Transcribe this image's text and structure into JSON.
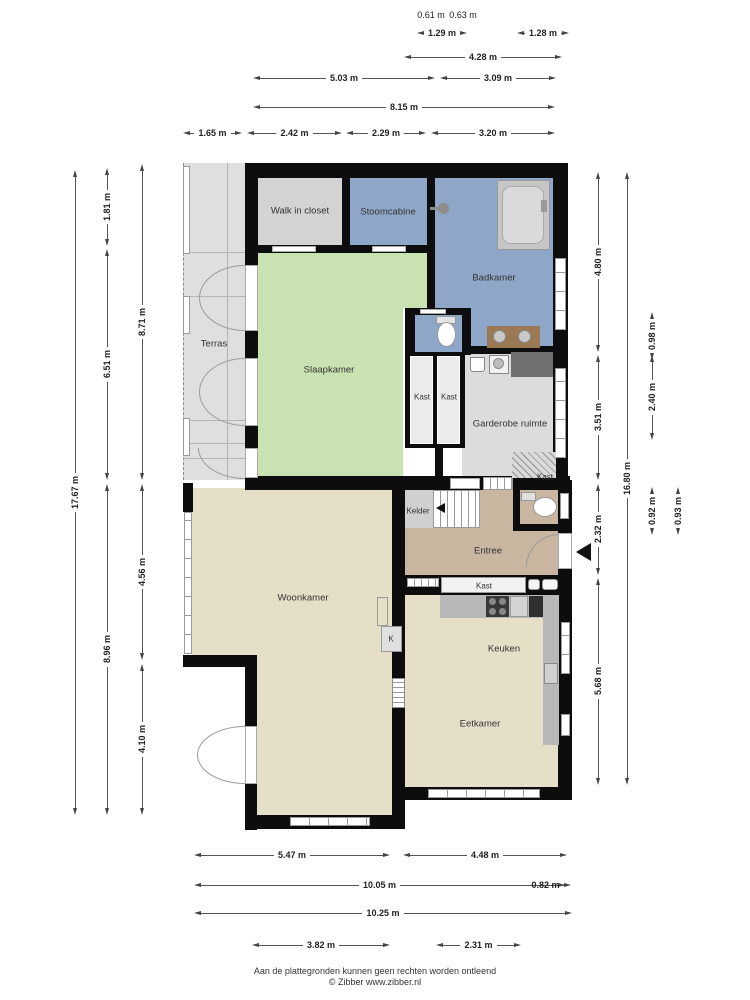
{
  "rooms": {
    "walk_in_closet": "Walk in closet",
    "stoomcabine": "Stoomcabine",
    "badkamer": "Badkamer",
    "terras": "Terras",
    "slaapkamer": "Slaapkamer",
    "kast_links": "Kast",
    "kast_rechts": "Kast",
    "garderobe": "Garderobe ruimte",
    "kast_hoek": "Kast",
    "kelder": "Kelder",
    "entree": "Entree",
    "kast_entree": "Kast",
    "kast_k": "K",
    "woonkamer": "Woonkamer",
    "keuken": "Keuken",
    "eetkamer": "Eetkamer"
  },
  "dims": {
    "top": [
      {
        "label": "0.61 m"
      },
      {
        "label": "0.63 m"
      },
      {
        "label": "1.29 m"
      },
      {
        "label": "1.28 m"
      },
      {
        "label": "4.28 m"
      },
      {
        "label": "5.03 m"
      },
      {
        "label": "3.09 m"
      },
      {
        "label": "8.15 m"
      },
      {
        "label": "1.65 m"
      },
      {
        "label": "2.42 m"
      },
      {
        "label": "2.29 m"
      },
      {
        "label": "3.20 m"
      }
    ],
    "left": [
      {
        "label": "17.67 m"
      },
      {
        "label": "1.81 m"
      },
      {
        "label": "6.51 m"
      },
      {
        "label": "8.96 m"
      },
      {
        "label": "8.71 m"
      },
      {
        "label": "4.56 m"
      },
      {
        "label": "4.10 m"
      }
    ],
    "right": [
      {
        "label": "4.80 m"
      },
      {
        "label": "3.51 m"
      },
      {
        "label": "2.32 m"
      },
      {
        "label": "5.68 m"
      },
      {
        "label": "16.80 m"
      },
      {
        "label": "0.98 m"
      },
      {
        "label": "2.40 m"
      },
      {
        "label": "0.92 m"
      },
      {
        "label": "0.93 m"
      }
    ],
    "bottom": [
      {
        "label": "5.47 m"
      },
      {
        "label": "4.48 m"
      },
      {
        "label": "10.05 m"
      },
      {
        "label": "0.82 m"
      },
      {
        "label": "10.25 m"
      },
      {
        "label": "3.82 m"
      },
      {
        "label": "2.31 m"
      }
    ]
  },
  "footer": {
    "disclaimer": "Aan de plattegronden kunnen geen rechten worden ontleend",
    "copyright": "© Zibber www.zibber.nl"
  },
  "colors": {
    "wall": "#0d0d0d",
    "bedroom_green": "#c9e2b2",
    "bath_blue": "#8ea6c7",
    "living_beige": "#e6dfc7",
    "entry_tan": "#c8b6a0",
    "closet_gray": "#d3d3d3",
    "terrace_gray": "#dfdfdf",
    "counter_brown": "#9b7954"
  }
}
